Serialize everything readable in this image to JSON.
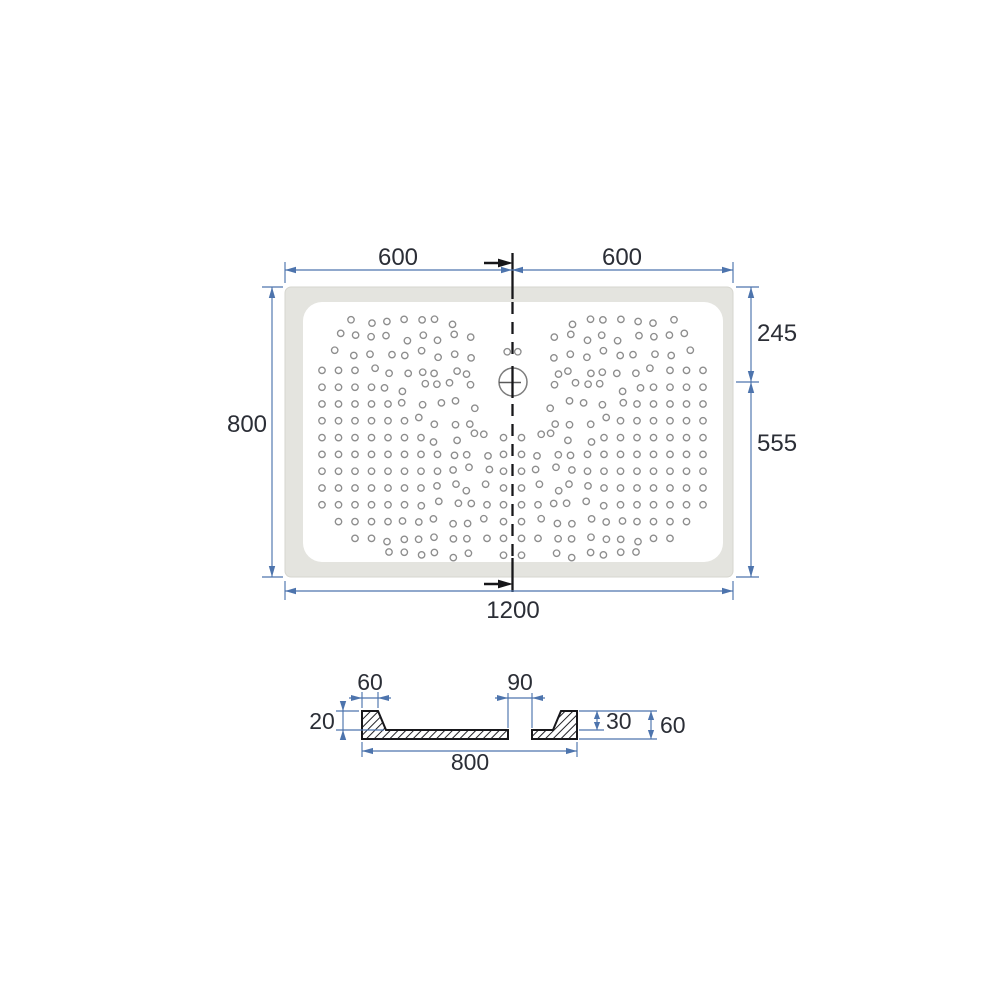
{
  "top_view": {
    "dimensions": {
      "width_left_half": "600",
      "width_right_half": "600",
      "depth": "800",
      "drain_offset_from_top": "245",
      "drain_offset_from_bottom": "555",
      "total_width": "1200"
    },
    "dot_pattern": {
      "origin": [
        322,
        320
      ],
      "spacing": [
        16.5,
        16.8
      ],
      "mirror_axis": 512.5,
      "radius": 3.2,
      "jitter": 9,
      "drain_center": [
        513,
        382
      ],
      "drain_clearance": 21,
      "rows": [
        "..sssssss...",
        ".sssssssss..",
        ".sssssssss.s",
        "gggsssssss..",
        "ggggssssss..",
        "gggggsssss..",
        "ggggggssss..",
        "gggggggssssg",
        "ggggggggsssg",
        "ggggggggsssg",
        "gggggggssssg",
        "ggggggssssgg",
        ".ggggssssssg",
        "..ggssssssgg",
        "....ssssss.g"
      ]
    }
  },
  "section_view": {
    "dimensions": {
      "rim_top_width": "60",
      "drain_opening": "90",
      "rim_lip_height": "20",
      "inner_depth": "30",
      "total_height": "60",
      "section_width": "800"
    }
  },
  "colors": {
    "dimension_blue": "#4d74ad",
    "line_black": "#161619",
    "tray_rim_gray": "#e4e4df",
    "dot_gray": "#8d8d8d",
    "text_dark": "#2b2e36"
  }
}
